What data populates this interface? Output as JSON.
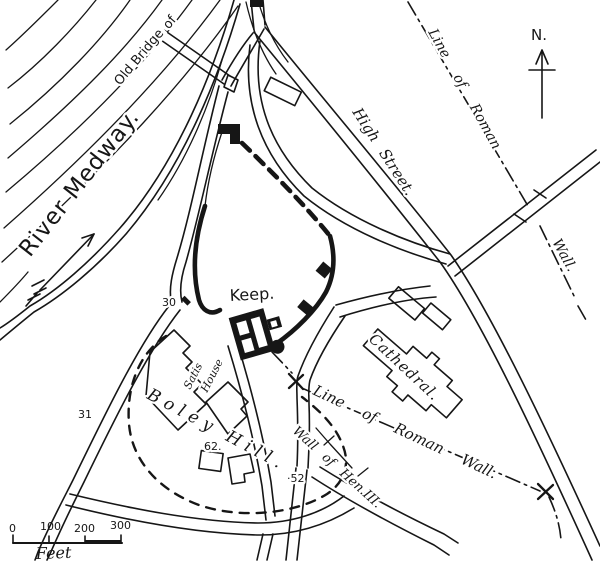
{
  "map": {
    "labels": {
      "river_medway": "River Medway.",
      "site_of": "Site of",
      "old_bridge": "Old Bridge",
      "high_street": "High Street.",
      "line_of_roman_ne": "Line of Roman",
      "wall_ne": "Wall.",
      "north": "N.",
      "keep": "Keep.",
      "cathedral": "Cathedral.",
      "boley_hill": "Boley Hill.",
      "satis_house_line1": "Satis",
      "satis_house_line2": "House",
      "line_of_roman_south": "Line of Roman Wall.",
      "wall_of_hen": "Wall of Hen.III."
    },
    "reference_numbers": {
      "gate": "30",
      "west_road": "31",
      "south_junction": "·52",
      "boley_plot": "62."
    },
    "scale": {
      "unit_label": "Feet",
      "ticks": [
        "0",
        "100",
        "200",
        "300"
      ]
    },
    "colors": {
      "ink": "#161616",
      "paper": "#ffffff"
    }
  }
}
